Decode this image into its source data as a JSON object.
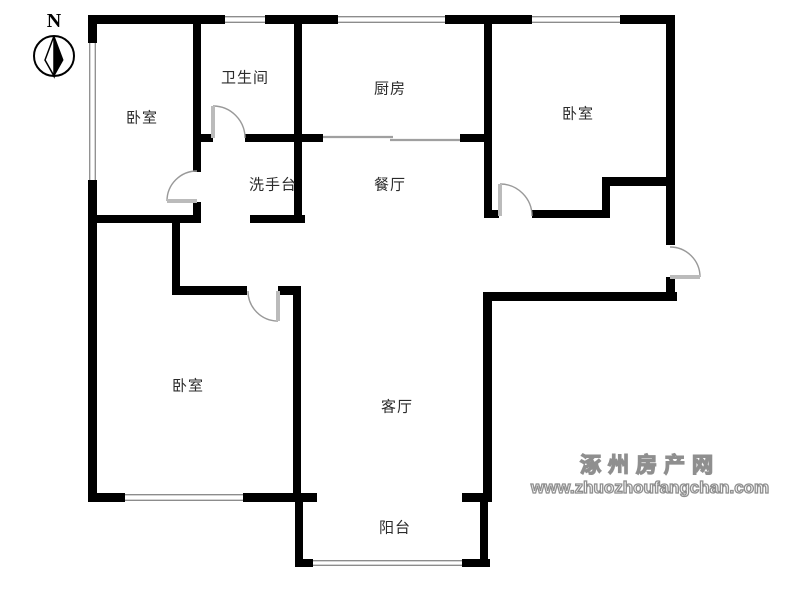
{
  "compass": {
    "label": "N"
  },
  "rooms": [
    {
      "id": "bedroom-top-left",
      "label": "卧室",
      "cx": 142,
      "cy": 117
    },
    {
      "id": "bathroom",
      "label": "卫生间",
      "cx": 245,
      "cy": 77
    },
    {
      "id": "kitchen",
      "label": "厨房",
      "cx": 390,
      "cy": 88
    },
    {
      "id": "bedroom-top-right",
      "label": "卧室",
      "cx": 578,
      "cy": 113
    },
    {
      "id": "washbasin",
      "label": "洗手台",
      "cx": 273,
      "cy": 184
    },
    {
      "id": "dining-room",
      "label": "餐厅",
      "cx": 390,
      "cy": 184
    },
    {
      "id": "bedroom-bottom-left",
      "label": "卧室",
      "cx": 188,
      "cy": 385
    },
    {
      "id": "living-room",
      "label": "客厅",
      "cx": 397,
      "cy": 406
    },
    {
      "id": "balcony",
      "label": "阳台",
      "cx": 395,
      "cy": 527
    }
  ],
  "watermark": {
    "site_name": "涿州房产网",
    "url": "www.zhuozhoufangchan.com",
    "color": "#8f8f8f"
  },
  "floorplan": {
    "wall_color": "#000000",
    "window_color": "#8c8c8c",
    "door_arc_color": "#999999",
    "door_leaf_color": "#bbbbbb",
    "walls": [
      [
        88,
        15,
        137,
        9
      ],
      [
        265,
        15,
        73,
        9
      ],
      [
        445,
        15,
        87,
        9
      ],
      [
        620,
        15,
        54,
        9
      ],
      [
        666,
        15,
        9,
        230
      ],
      [
        666,
        277,
        9,
        24
      ],
      [
        88,
        15,
        9,
        28
      ],
      [
        88,
        180,
        9,
        322
      ],
      [
        88,
        493,
        37,
        9
      ],
      [
        243,
        493,
        74,
        9
      ],
      [
        295,
        497,
        8,
        69
      ],
      [
        295,
        559,
        18,
        8
      ],
      [
        462,
        559,
        28,
        8
      ],
      [
        480,
        497,
        8,
        69
      ],
      [
        462,
        493,
        28,
        9
      ],
      [
        483,
        292,
        9,
        210
      ],
      [
        483,
        292,
        194,
        9
      ],
      [
        193,
        15,
        8,
        157
      ],
      [
        193,
        202,
        8,
        21
      ],
      [
        195,
        134,
        18,
        8
      ],
      [
        245,
        134,
        57,
        8
      ],
      [
        294,
        15,
        8,
        208
      ],
      [
        302,
        134,
        21,
        8
      ],
      [
        460,
        134,
        25,
        8
      ],
      [
        484,
        15,
        8,
        203
      ],
      [
        488,
        210,
        11,
        8
      ],
      [
        532,
        210,
        78,
        8
      ],
      [
        602,
        177,
        68,
        9
      ],
      [
        602,
        177,
        8,
        41
      ],
      [
        88,
        215,
        112,
        8
      ],
      [
        250,
        215,
        55,
        8
      ],
      [
        172,
        223,
        8,
        70
      ],
      [
        172,
        286,
        75,
        9
      ],
      [
        278,
        286,
        23,
        9
      ],
      [
        293,
        286,
        8,
        211
      ]
    ],
    "windows": [
      {
        "rect": [
          225,
          16,
          40,
          7
        ],
        "orient": "h"
      },
      {
        "rect": [
          338,
          16,
          107,
          7
        ],
        "orient": "h"
      },
      {
        "rect": [
          532,
          16,
          88,
          7
        ],
        "orient": "h"
      },
      {
        "rect": [
          89,
          43,
          7,
          137
        ],
        "orient": "v"
      },
      {
        "rect": [
          125,
          494,
          118,
          7
        ],
        "orient": "h"
      },
      {
        "rect": [
          313,
          560,
          149,
          6
        ],
        "orient": "h"
      }
    ],
    "doors": [
      {
        "name": "bathroom-door",
        "leaf": [
          213,
          138,
          213,
          106
        ],
        "arc": "M213,106 A32,32 0 0 1 245,138"
      },
      {
        "name": "bedroom-top-left-door",
        "leaf": [
          197,
          201,
          167,
          201
        ],
        "arc": "M167,201 A30,30 0 0 1 197,171"
      },
      {
        "name": "bedroom-bottom-left-door",
        "leaf": [
          278,
          291,
          278,
          321
        ],
        "arc": "M248,291 A30,30 0 0 0 278,321"
      },
      {
        "name": "bedroom-top-right-door",
        "leaf": [
          500,
          216,
          500,
          184
        ],
        "arc": "M500,184 A32,32 0 0 1 532,216"
      },
      {
        "name": "entry-door",
        "leaf": [
          670,
          277,
          700,
          277
        ],
        "arc": "M670,247 A30,30 0 0 1 700,277"
      }
    ],
    "sliding_doors": [
      [
        323,
        137,
        393,
        137
      ],
      [
        390,
        140,
        460,
        140
      ]
    ]
  }
}
